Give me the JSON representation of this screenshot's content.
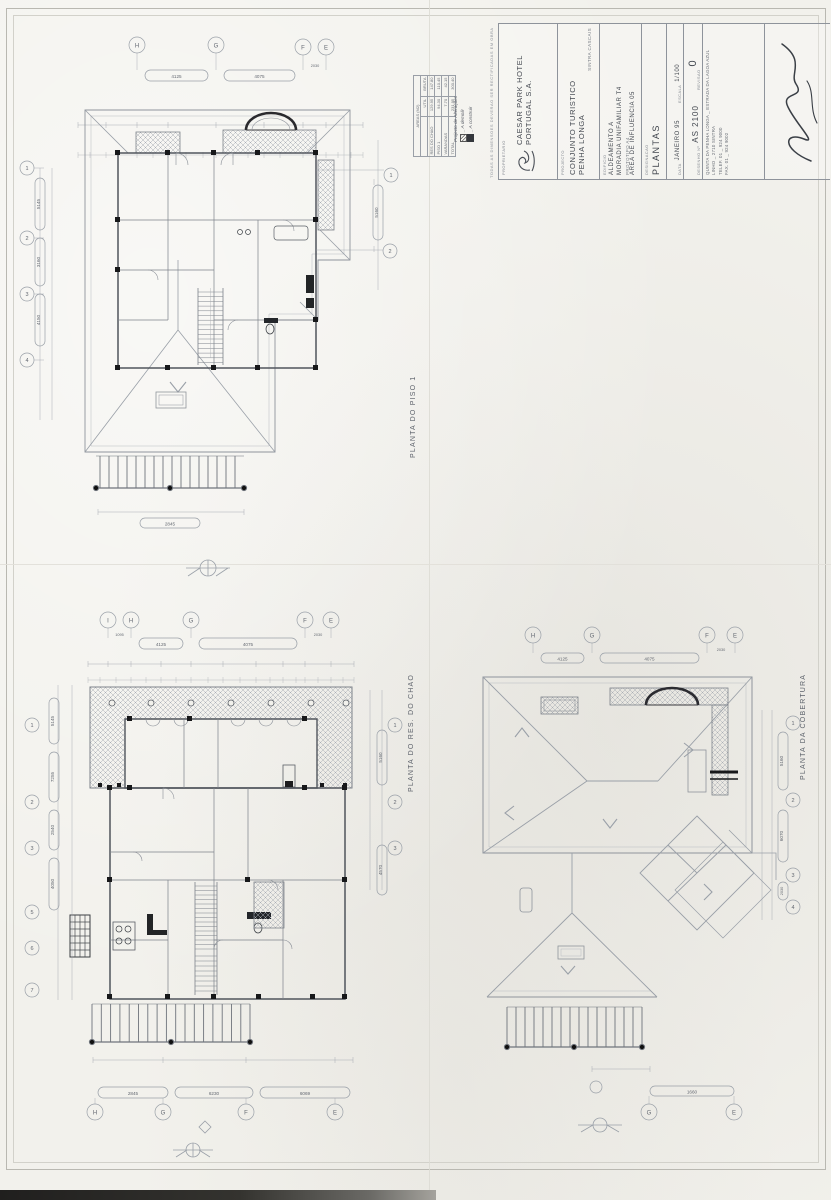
{
  "plans": {
    "piso1": {
      "title": "PLANTA DO PISO 1",
      "grid_top": [
        "H",
        "G",
        "F",
        "E"
      ],
      "grid_left": [
        "1",
        "2",
        "3",
        "4"
      ],
      "grid_right": [
        "1",
        "2"
      ],
      "dims_top": [
        "4125",
        "4075",
        "2030"
      ],
      "dims_left": [
        "5145",
        "3160",
        "4150"
      ],
      "dims_right": [
        "5160"
      ],
      "dim_bottom": "2845"
    },
    "res_do_chao": {
      "title": "PLANTA DO RES. DO CHAO",
      "grid_top": [
        "I",
        "H",
        "G",
        "F",
        "E"
      ],
      "grid_bottom": [
        "H",
        "G",
        "F",
        "E"
      ],
      "grid_left": [
        "1",
        "2",
        "3",
        "5",
        "6",
        "7"
      ],
      "grid_right": [
        "1",
        "2",
        "3"
      ],
      "dims_top": [
        "1095",
        "4125",
        "4075",
        "2030"
      ],
      "dims_left": [
        "5145",
        "7255",
        "2540",
        "4050"
      ],
      "dims_right": [
        "5160",
        "4570"
      ],
      "dims_bottom": [
        "2845",
        "6230",
        "6069"
      ]
    },
    "cobertura": {
      "title": "PLANTA DA COBERTURA",
      "grid_top": [
        "H",
        "G",
        "F",
        "E"
      ],
      "grid_right": [
        "1",
        "2",
        "3",
        "4"
      ],
      "grid_bottom": [
        "G",
        "E"
      ],
      "dims_top": [
        "4125",
        "4075",
        "2030"
      ],
      "dims_right": [
        "5160",
        "6070",
        "2030"
      ],
      "dims_bottom": [
        "1660"
      ]
    }
  },
  "areas_table": {
    "title": "AREAS  (M2)",
    "col_util": "UTIL",
    "col_bruta": "BRUTA",
    "rows": [
      {
        "label": "RES DO CHAO",
        "util": "129.95",
        "bruta": "147.80"
      },
      {
        "label": "PISO 1",
        "util": "94.30",
        "bruta": "110.45"
      },
      {
        "label": "VARANDAS",
        "util": "7.70",
        "bruta": "42.15"
      },
      {
        "label": "TOTAL",
        "util": "231.95",
        "bruta": "300.40"
      }
    ]
  },
  "alterations_note": {
    "title": "Projecto de Alterações",
    "legend_demolish": "_ A demolir",
    "legend_build": "_ A construir"
  },
  "title_block": {
    "disclaimer": "TODAS AS DIMENSOES DEVERAO SER RECTIFICADAS EM OBRA",
    "owner_label": "PROPRIETARIO",
    "owner_line1": "CAESAR PARK HOTEL",
    "owner_line2": "PORTUGAL S.A.",
    "project_label": "PROJECTO",
    "project_line1": "CONJUNTO TURISTICO",
    "project_line2": "PENHA LONGA",
    "project_sub": "SINTRA CASCAIS",
    "building_label": "EDIFICIO",
    "building_line1": "ALDEAMENTO A",
    "building_line2": "MORADIA UNIFAMILIAR T4",
    "building_line3": "PROTOTIPO A4",
    "building_line4": "AREA DE INFLUENCIA 05",
    "designation_label": "DESIGNACAO",
    "designation": "PLANTAS",
    "date_label": "DATA",
    "date_value": "JANEIRO 95",
    "scale_label": "ESCALA",
    "scale_value": "1/100",
    "drawing_label": "DESENHO Nº",
    "drawing_value": "AS 2100",
    "revision_label": "REVISAO",
    "revision_value": "0"
  },
  "address": {
    "line1": "QUINTA DA PENHA LONGA _ ESTRADA DA LAGOA AZUL",
    "line2": "LINHO _ 2710 SINTRA",
    "line3": "TELEF. 01 _ 924 9000",
    "line4": "FAX. 01 _ 924 9002"
  }
}
